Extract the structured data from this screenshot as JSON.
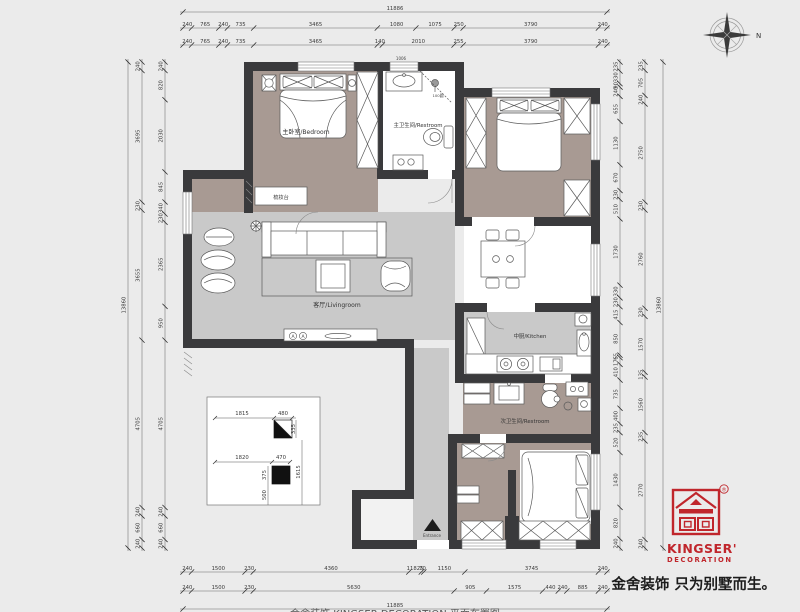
{
  "title_dims": {
    "top_total": "11886",
    "bottom_total": "11885",
    "left_total": "13860",
    "right_total": "13860"
  },
  "chains": {
    "top_row1": [
      "240",
      "765",
      "240",
      "735",
      "3465",
      "1080",
      "1075",
      "250",
      "3790",
      "240"
    ],
    "top_row2": [
      "240",
      "765",
      "240",
      "735",
      "3465",
      "140",
      "2010",
      "255",
      "3790",
      "240"
    ],
    "bottom_row1": [
      "240",
      "1500",
      "230",
      "4360",
      "11825",
      "70",
      "1150",
      "3745",
      "240"
    ],
    "bottom_row2": [
      "240",
      "1500",
      "230",
      "5630",
      "905",
      "1575",
      "440",
      "240",
      "885",
      "240"
    ],
    "left_outer": [
      "240",
      "3695",
      "230",
      "3655",
      "4705",
      "240",
      "660",
      "240"
    ],
    "left_inner": [
      "240",
      "820",
      "2030",
      "845",
      "340",
      "230",
      "2365",
      "950",
      "4705",
      "240",
      "660",
      "240"
    ],
    "right_inner": [
      "235",
      "330",
      "90",
      "240",
      "655",
      "1130",
      "670",
      "230",
      "510",
      "1730",
      "330",
      "230",
      "415",
      "850",
      "65",
      "175",
      "410",
      "735",
      "400",
      "235",
      "520",
      "1430",
      "820",
      "240"
    ],
    "right_mid": [
      "235",
      "705",
      "240",
      "2750",
      "230",
      "2760",
      "230",
      "1570",
      "135",
      "1560",
      "235",
      "2770",
      "240"
    ]
  },
  "rooms": {
    "master_bedroom": "主卧室/Bedroom",
    "master_bath": "主卫生间/Restroom",
    "living": "客厅/Livingroom",
    "kitchen": "中厨/Kitchen",
    "second_bath": "次卫生间/Restroom",
    "dresser": "梳妆台",
    "entrance": "Entrance"
  },
  "annotations": {
    "bath_top_dim": "1006",
    "shower_note": "100圆",
    "switch_a": "A"
  },
  "detail_dims": {
    "row1_offset": "1815",
    "row1_width": "480",
    "row1_height": "335",
    "row2_offset": "1820",
    "row2_width": "470",
    "row2_side": "375",
    "row2_below": "500",
    "row2_height": "1615"
  },
  "compass": {
    "north": "N"
  },
  "logo": {
    "brand": "KINGSER'",
    "division": "DECORATION",
    "registered": "®",
    "tagline": "金舍装饰 只为别墅而生。"
  },
  "footer_caption": "金舍装饰 KINGSER DECORATION 平面布置图",
  "colors": {
    "wall": "#3a3a3c",
    "floor_taupe": "#a89a93",
    "floor_gray": "#c9c9c9",
    "accent_red": "#c0262c",
    "background": "#ebebeb"
  }
}
